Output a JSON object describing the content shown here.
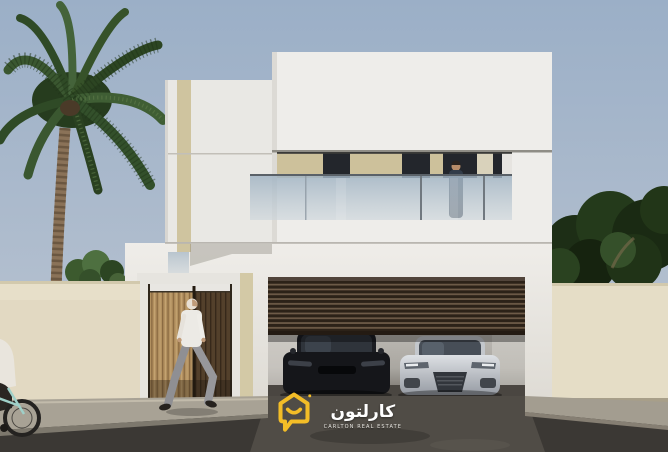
{
  "meta": {
    "type": "architectural-exterior-render",
    "description": "3D render of a modern two-storey white villa: glass balcony with a standing man, slatted wooden entrance gate with a walking man, open louvered garage with a black car and a silver sports car, palm tree left, dark trees right, beige boundary walls, cyclist at left edge, real-estate logo watermark at bottom center"
  },
  "logo": {
    "arabic_name": "كارلتون",
    "english_name": "CARLTON REAL ESTATE",
    "icon": "smiling-house-speech-bubble-icon",
    "brand_color": "#f3bd27",
    "text_color": "#ffffff"
  },
  "scene": {
    "sky": {
      "top": "#9db0c7",
      "bottom": "#c2cbd5"
    },
    "villa": {
      "walls_white": "#edebe7",
      "accent_beige_strip": "#cfc49f",
      "glass_balustrade": "#aebfcc",
      "window_glass_dark": "#23262c",
      "garage_louver_door": "#4a3a2c",
      "entrance_door_light_wood": "#b2905f",
      "entrance_door_dark_wood": "#53402b"
    },
    "environment": {
      "boundary_wall_beige": "#e7dfc9",
      "sidewalk": "#a8a295",
      "road_asphalt": "#3b3834",
      "palm_foliage_green": "#3a5730",
      "background_trees_green": "#263a1e"
    },
    "vehicles": [
      {
        "name": "black-car",
        "color": "#17181c"
      },
      {
        "name": "silver-car",
        "color": "#c9ccd1"
      }
    ],
    "people": [
      "balcony-person",
      "walking-person",
      "cyclist"
    ]
  }
}
